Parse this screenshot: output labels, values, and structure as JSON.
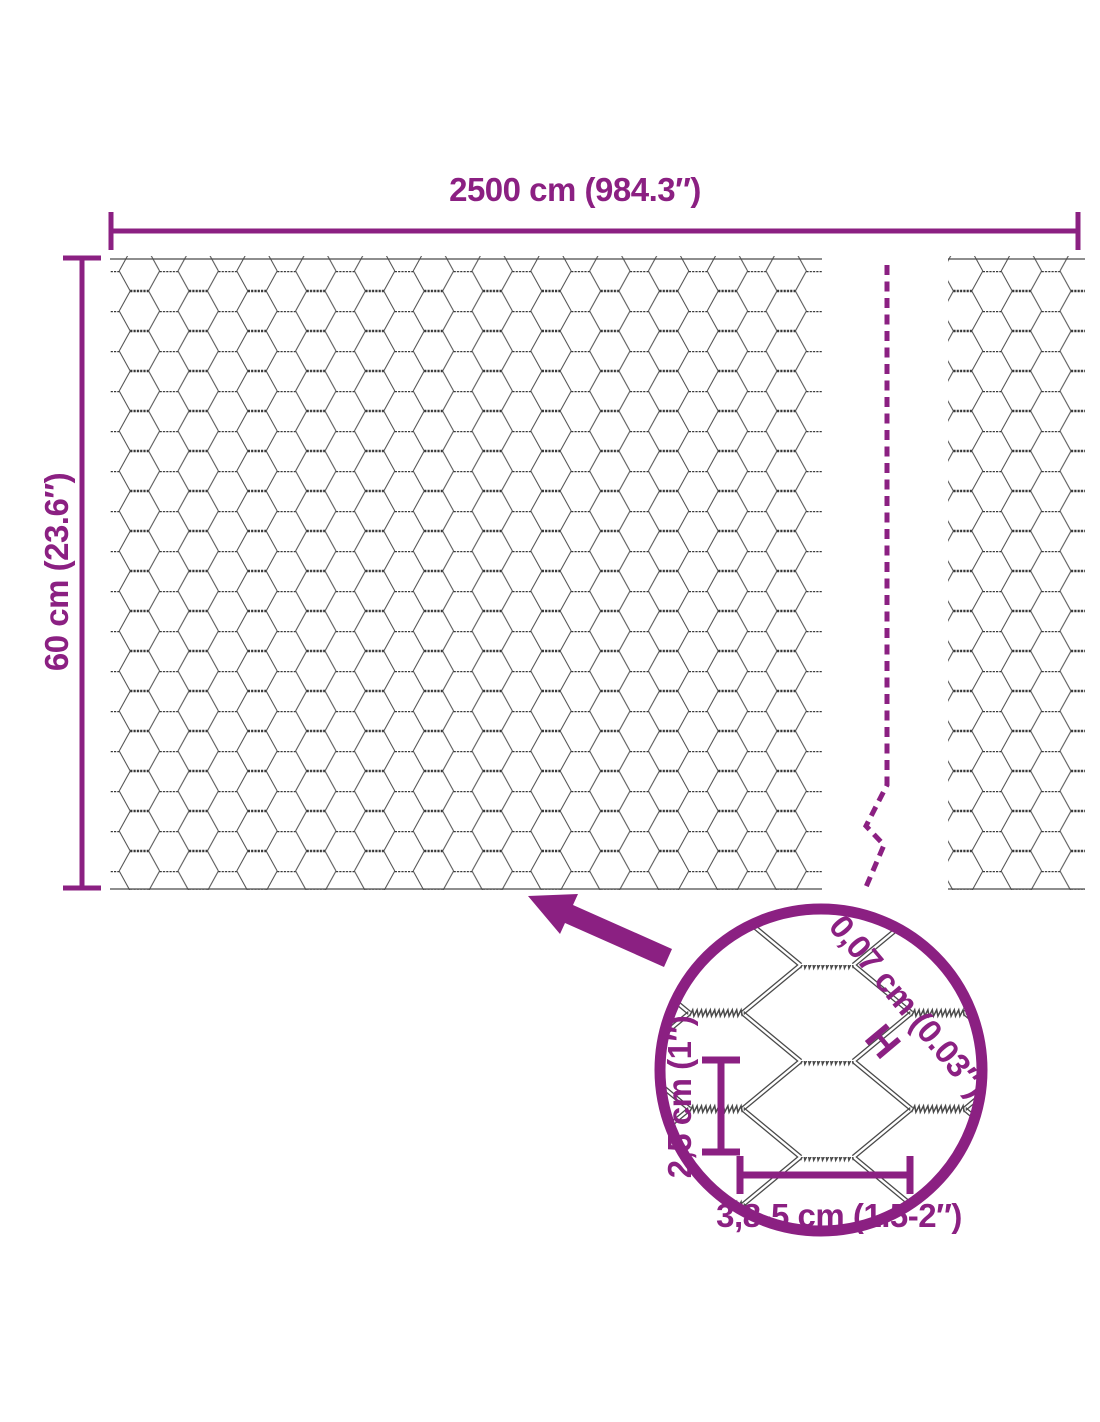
{
  "labels": {
    "total_width": "2500 cm (984.3″)",
    "total_height": "60 cm (23.6″)",
    "wire_thickness": "0,07 cm (0.03″)",
    "wire_thickness_marker": "H",
    "mesh_opening_height": "2,5 cm (1″)",
    "mesh_opening_width": "3,8-5 cm (1.5-2″)"
  },
  "colors": {
    "accent": "#8B2082",
    "wire": "#4A4A4A"
  }
}
